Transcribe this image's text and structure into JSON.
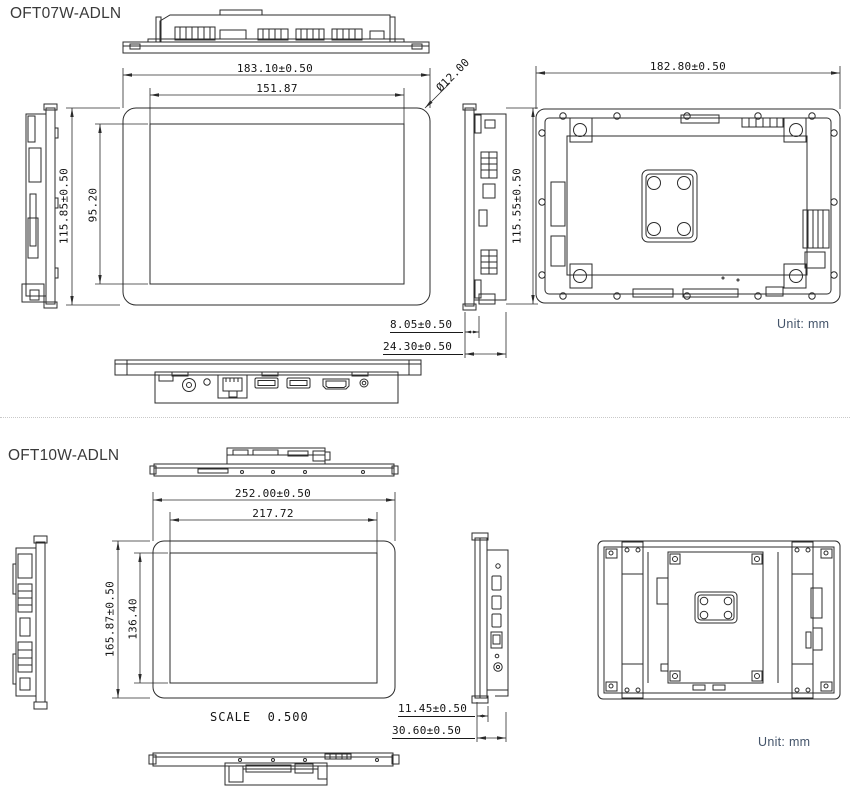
{
  "models": {
    "oft07w": {
      "title": "OFT07W-ADLN",
      "unit_label": "Unit: mm",
      "dims": {
        "overall_width": "183.10±0.50",
        "display_width": "151.87",
        "corner_diameter": "Ø12.00",
        "overall_height": "115.85±0.50",
        "display_height": "95.20",
        "rear_height": "115.55±0.50",
        "rear_width": "182.80±0.50",
        "front_depth": "8.05±0.50",
        "total_depth": "24.30±0.50"
      }
    },
    "oft10w": {
      "title": "OFT10W-ADLN",
      "unit_label": "Unit: mm",
      "scale_label": "SCALE  0.500",
      "dims": {
        "overall_width": "252.00±0.50",
        "display_width": "217.72",
        "overall_height": "165.87±0.50",
        "display_height": "136.40",
        "front_depth": "11.45±0.50",
        "total_depth": "30.60±0.50"
      }
    }
  },
  "colors": {
    "line": "#2b2b2b",
    "gasket_green": "#8ab968",
    "active_area_orange": "#f0b866",
    "unit_text": "#44546a"
  }
}
